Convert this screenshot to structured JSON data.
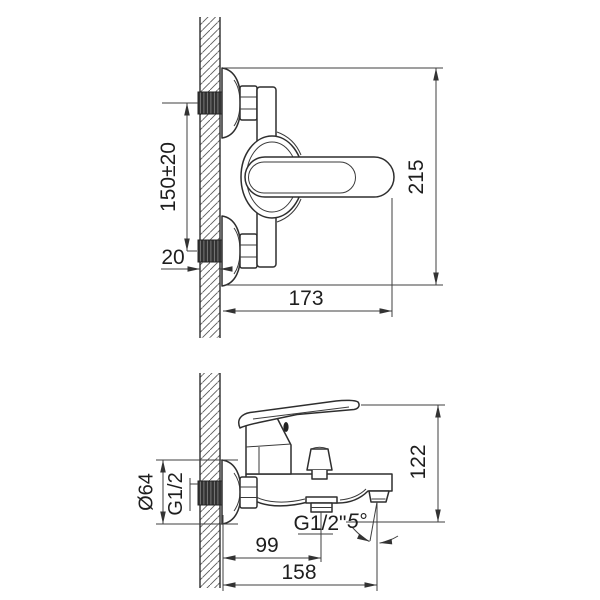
{
  "drawing": {
    "type": "technical-installation-drawing",
    "subject": "wall-mounted bath mixer faucet, two orthographic views with dimensions",
    "units": "mm",
    "line_color": "#2e2e2e",
    "background": "#ffffff"
  },
  "top_view": {
    "name": "front installation view",
    "dims": {
      "center_distance": "150±20",
      "wall_thickness": "20",
      "body_depth": "173",
      "overall_height": "215"
    }
  },
  "bottom_view": {
    "name": "side profile view",
    "dims": {
      "escutcheon_diameter": "Ø64",
      "inlet_thread": "G1/2",
      "overall_height": "122",
      "outlet_thread": "G1/2\"",
      "spout_angle": "5°",
      "outlet_offset": "99",
      "spout_reach": "158"
    }
  }
}
